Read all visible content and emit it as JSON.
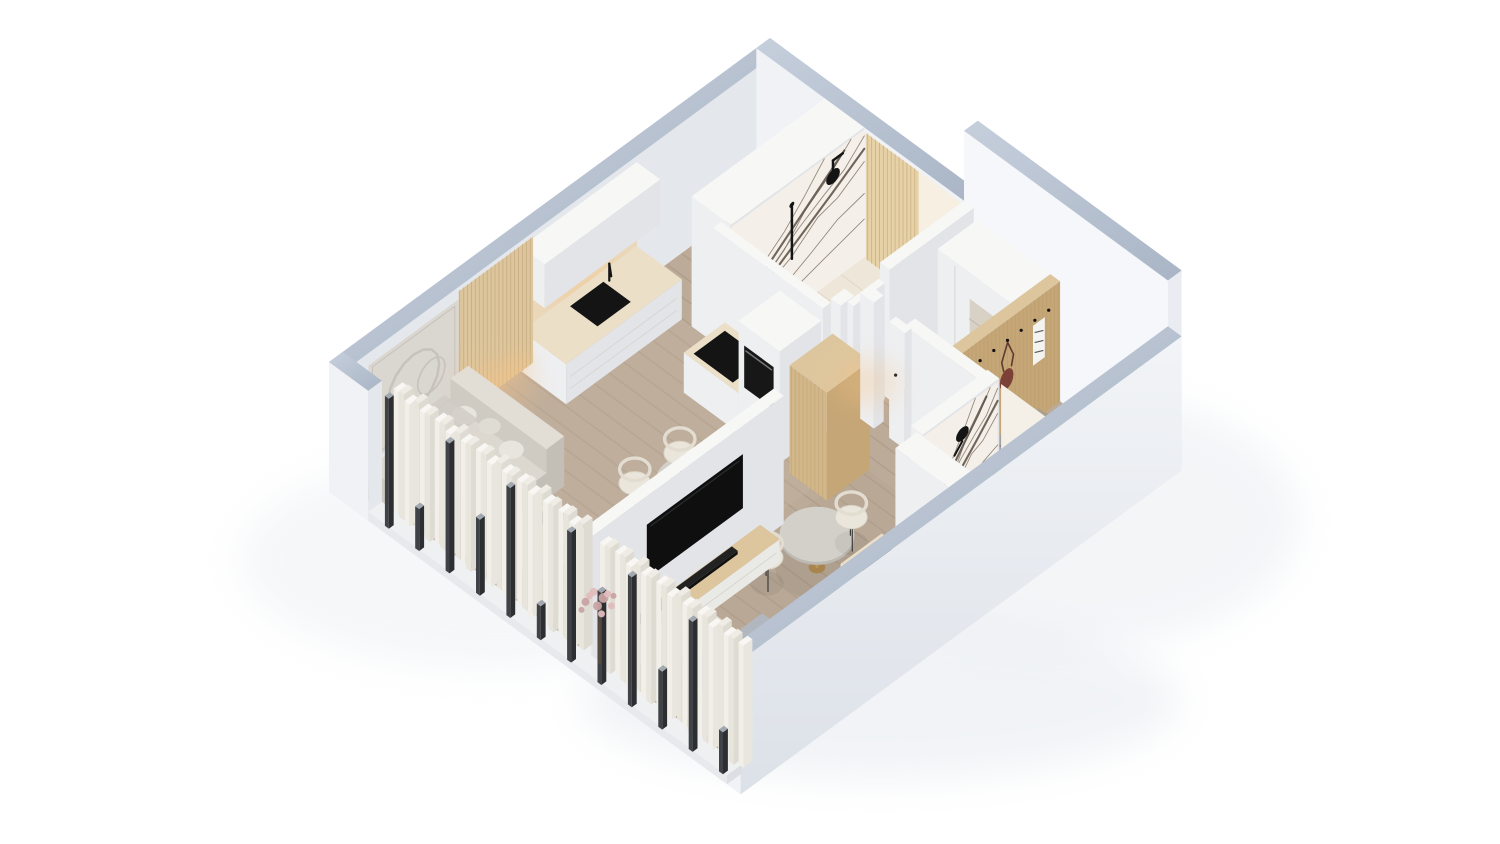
{
  "meta": {
    "title": "Isometric apartment cutaway render",
    "description": "Axonometric 3D cutaway floor-plan rendering of two adjacent studio apartments with furniture, on a white background. No text or UI controls are present in the image."
  },
  "palette": {
    "page": "#ffffff",
    "shadow": "#dde3ea",
    "cutTopA": "#c6cfdc",
    "cutTopB": "#a9b5c6",
    "wallU": "#e4e7ec",
    "wallV": "#f0f2f5",
    "wallTU": "#e9ecf1",
    "wallTV": "#f5f7fa",
    "seFaceA": "#f2f4f7",
    "seFaceB": "#dce1e8",
    "whiteT": "#f7f7f6",
    "whiteU": "#e2e4e8",
    "whiteV": "#eeeff1",
    "floorBase": "#bcab99",
    "floorStripe": "#a08f7d",
    "floorTintLiving": "#c8b7a5",
    "floorTintBed": "#b09f8d",
    "tile": "#eee7d9",
    "tileLine": "#dbd0bc",
    "tile2": "#efe9dc",
    "counterTop": "#ecdfc8",
    "splash": "#ead8ba",
    "oakT": "#ddc69e",
    "oakU": "#c5a676",
    "oakV": "#d2b78a",
    "oakLine": "#b99c6c",
    "marble": "#f4f0e9",
    "vein": "#6d5d4e",
    "veinBold": "#4e4237",
    "black": "#141414",
    "tvBlack": "#0f0f10",
    "tvGlint": "#2e3033",
    "sofaT": "#dcd8d0",
    "sofaU": "#c3bfb6",
    "sofaV": "#cfcbc2",
    "pillowSofa": "#e8e5de",
    "bedT": "#c9ccd3",
    "bedU": "#a9adb6",
    "bedV": "#b9bdc5",
    "pillowT": "#e9ebf0",
    "pillowU": "#d3d7de",
    "pillowV": "#dee2e8",
    "throw": "#b2b7bf",
    "crease": "#9aa0aa",
    "benchT": "#dedbd4",
    "benchU": "#c7c4bd",
    "benchV": "#d3d0c9",
    "poufT": "#a3a2a2",
    "poufU": "#8a898a",
    "poufV": "#969595",
    "curAT": "#f9f7f3",
    "curAU": "#e9e6df",
    "curAV": "#f2efe9",
    "curBT": "#efece5",
    "curBU": "#dedbd3",
    "curBV": "#e8e5dd",
    "mullDark": "#2c2e31",
    "mullSide": "#3f4246",
    "mullTop": "#a2a8b0",
    "sillT": "#eef0f2",
    "sillU": "#dbdee2",
    "sillV": "#e7e9ed",
    "gold": "#b9995f",
    "goldDark": "#a8854e",
    "stemGray": "#8f8c86",
    "glow": "#f5c286",
    "glowLine": "#ffd9a0",
    "mat": "#a79d91",
    "slipper": "#b14a3f",
    "bag": "#7c4136",
    "scarf": "#f3f3f0",
    "scarfStripe": "#565a60",
    "trunk": "#5a4a3c",
    "blossomA": "#e0bdbd",
    "blossomB": "#c9a3a3",
    "chairSeat": "#eae6db",
    "chairRing": "#e2ddd0",
    "chairLeg": "#3c3c3c",
    "tableTop": "#d3d0ca",
    "tableSide": "#bdbab4",
    "artBg": "#dad6d0",
    "artLine": "#c7c2bb",
    "handle": "#777777",
    "seam": "#d8d5cf",
    "nicheBg": "#d7d1c6",
    "nicheShelf": "#c3bdb2"
  },
  "scene": {
    "view": "isometric cutaway, camera from south, walls sectioned with blue-grey cut tops",
    "units": [
      {
        "name": "studio-left",
        "rooms": [
          {
            "name": "kitchen",
            "items": [
              "white-base-cabinets",
              "beige-countertop",
              "black-sink",
              "black-faucet",
              "black-cooktop",
              "built-in-oven-column",
              "tall-oak-cabinet",
              "white-upper-cabinets",
              "beige-backsplash"
            ]
          },
          {
            "name": "bathroom-marble",
            "items": [
              "white-bathtub",
              "marble-feature-wall",
              "black-round-rain-shower",
              "black-hand-shower",
              "oak-slat-panel"
            ]
          },
          {
            "name": "living-room",
            "items": [
              "l-shaped-light-grey-sofa",
              "cushions",
              "white-coffee-table",
              "vases-with-flowers",
              "relief-wall-art",
              "oak-slat-accent-wall-with-warm-led"
            ]
          },
          {
            "name": "dining",
            "items": [
              "round-table",
              "three-cream-chairs"
            ]
          }
        ]
      },
      {
        "name": "studio-right",
        "rooms": [
          {
            "name": "entry-hall",
            "items": [
              "white-wardrobe-with-niche",
              "oak-slat-coat-wall",
              "black-hooks",
              "striped-scarf",
              "brown-shoulder-bag",
              "grey-pouf",
              "grey-doormat",
              "red-slippers"
            ]
          },
          {
            "name": "bathroom-marble",
            "items": [
              "white-bathtub",
              "marble-feature-wall",
              "black-round-sconce"
            ]
          },
          {
            "name": "kitchenette",
            "items": [
              "white-cabinets",
              "black-cooktop",
              "black-sink",
              "black-faucet"
            ]
          },
          {
            "name": "dining",
            "items": [
              "round-table-gold-base",
              "two-cream-chairs"
            ]
          },
          {
            "name": "sleeping-area",
            "items": [
              "double-bed-grey-bedding",
              "two-pillows",
              "foot-bench",
              "tv-partition-wall",
              "wall-mounted-tv",
              "media-console-oak-top",
              "black-soundbar",
              "blossom-tree-decor"
            ]
          }
        ]
      }
    ],
    "envelope": [
      "cut-exterior-walls",
      "floor-to-ceiling-windows",
      "dark-window-mullions",
      "pleated-white-curtains",
      "wood-plank-flooring"
    ]
  }
}
